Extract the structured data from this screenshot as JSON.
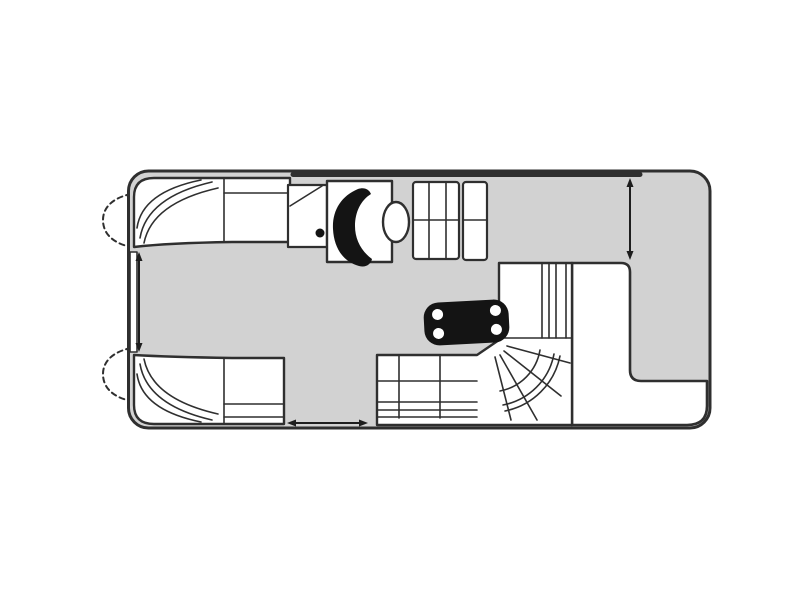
{
  "meta": {
    "type": "floor-plan",
    "subject": "pontoon-boat-deck-plan-top-view",
    "orientation": "bow-left-stern-right"
  },
  "canvas": {
    "width": 800,
    "height": 600,
    "background": "#ffffff"
  },
  "colors": {
    "background": "#ffffff",
    "deck": "#d2d2d2",
    "outline": "#2f2f2f",
    "furniture": "#ffffff",
    "table": "#141414",
    "cupholder": "#ffffff",
    "arrow": "#1e1e1e"
  },
  "parts": {
    "hull": "pontoon deck hull",
    "pontoon_nose_starboard": "starboard pontoon nose cone",
    "pontoon_nose_port": "port pontoon nose cone",
    "bow_bench_starboard": "starboard bow curved lounge",
    "bow_bench_port": "port bow curved lounge",
    "bow_gate": "bow entry gate",
    "privacy_console": "changing console with cup holder",
    "helm_console": "helm console with steering station",
    "captain_seat": "captain seat",
    "galley_unit": "galley / refreshment unit",
    "cocktail_table": "cocktail table with four cup holders",
    "aft_l_lounge": "aft wrap-around L lounge",
    "stern_deck": "stern deck area",
    "rear_platform": "rear platform",
    "stern_gate": "starboard stern gate",
    "port_side_gate": "port side gate"
  }
}
